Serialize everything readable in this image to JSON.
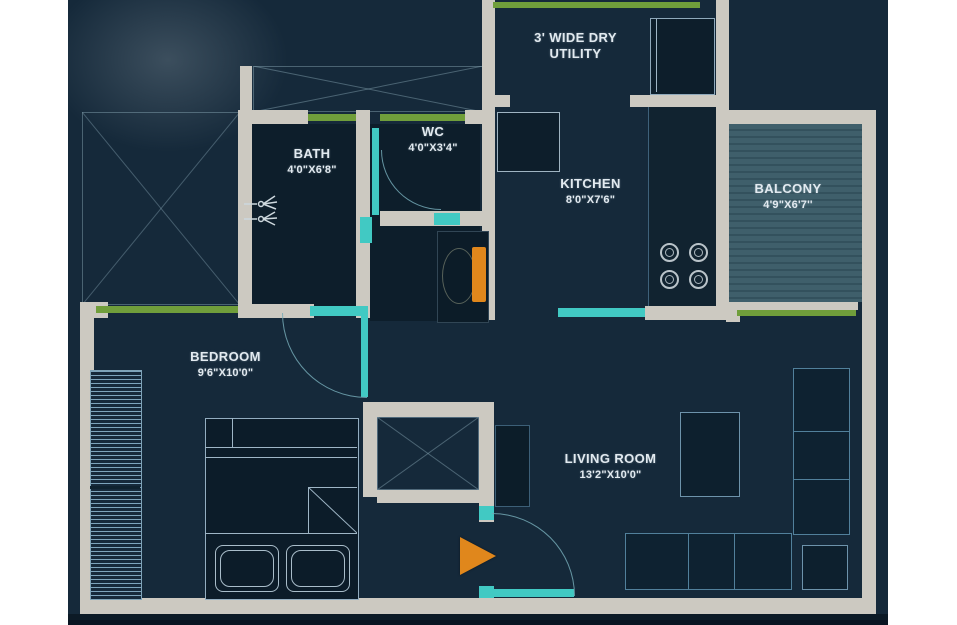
{
  "colors": {
    "bg": "#15293a",
    "room": "#0d1e2b",
    "wall": "#ccc9c1",
    "green": "#709e3b",
    "teal": "#41c9c3",
    "orange": "#e0871c",
    "line": "#5d87a5",
    "line_light": "#9fb6c6",
    "text": "#e2eaf0",
    "margin": "#ffffff"
  },
  "rooms": {
    "dry_utility": {
      "line1": "3' WIDE DRY",
      "line2": "UTILITY"
    },
    "bath": {
      "name": "BATH",
      "dims": "4'0\"X6'8\""
    },
    "wc": {
      "name": "WC",
      "dims": "4'0\"X3'4\""
    },
    "kitchen": {
      "name": "KITCHEN",
      "dims": "8'0\"X7'6\""
    },
    "balcony": {
      "name": "BALCONY",
      "dims": "4'9\"X6'7''"
    },
    "bedroom": {
      "name": "BEDROOM",
      "dims": "9'6\"X10'0\""
    },
    "living_room": {
      "name": "LIVING ROOM",
      "dims": "13'2\"X10'0\""
    }
  }
}
